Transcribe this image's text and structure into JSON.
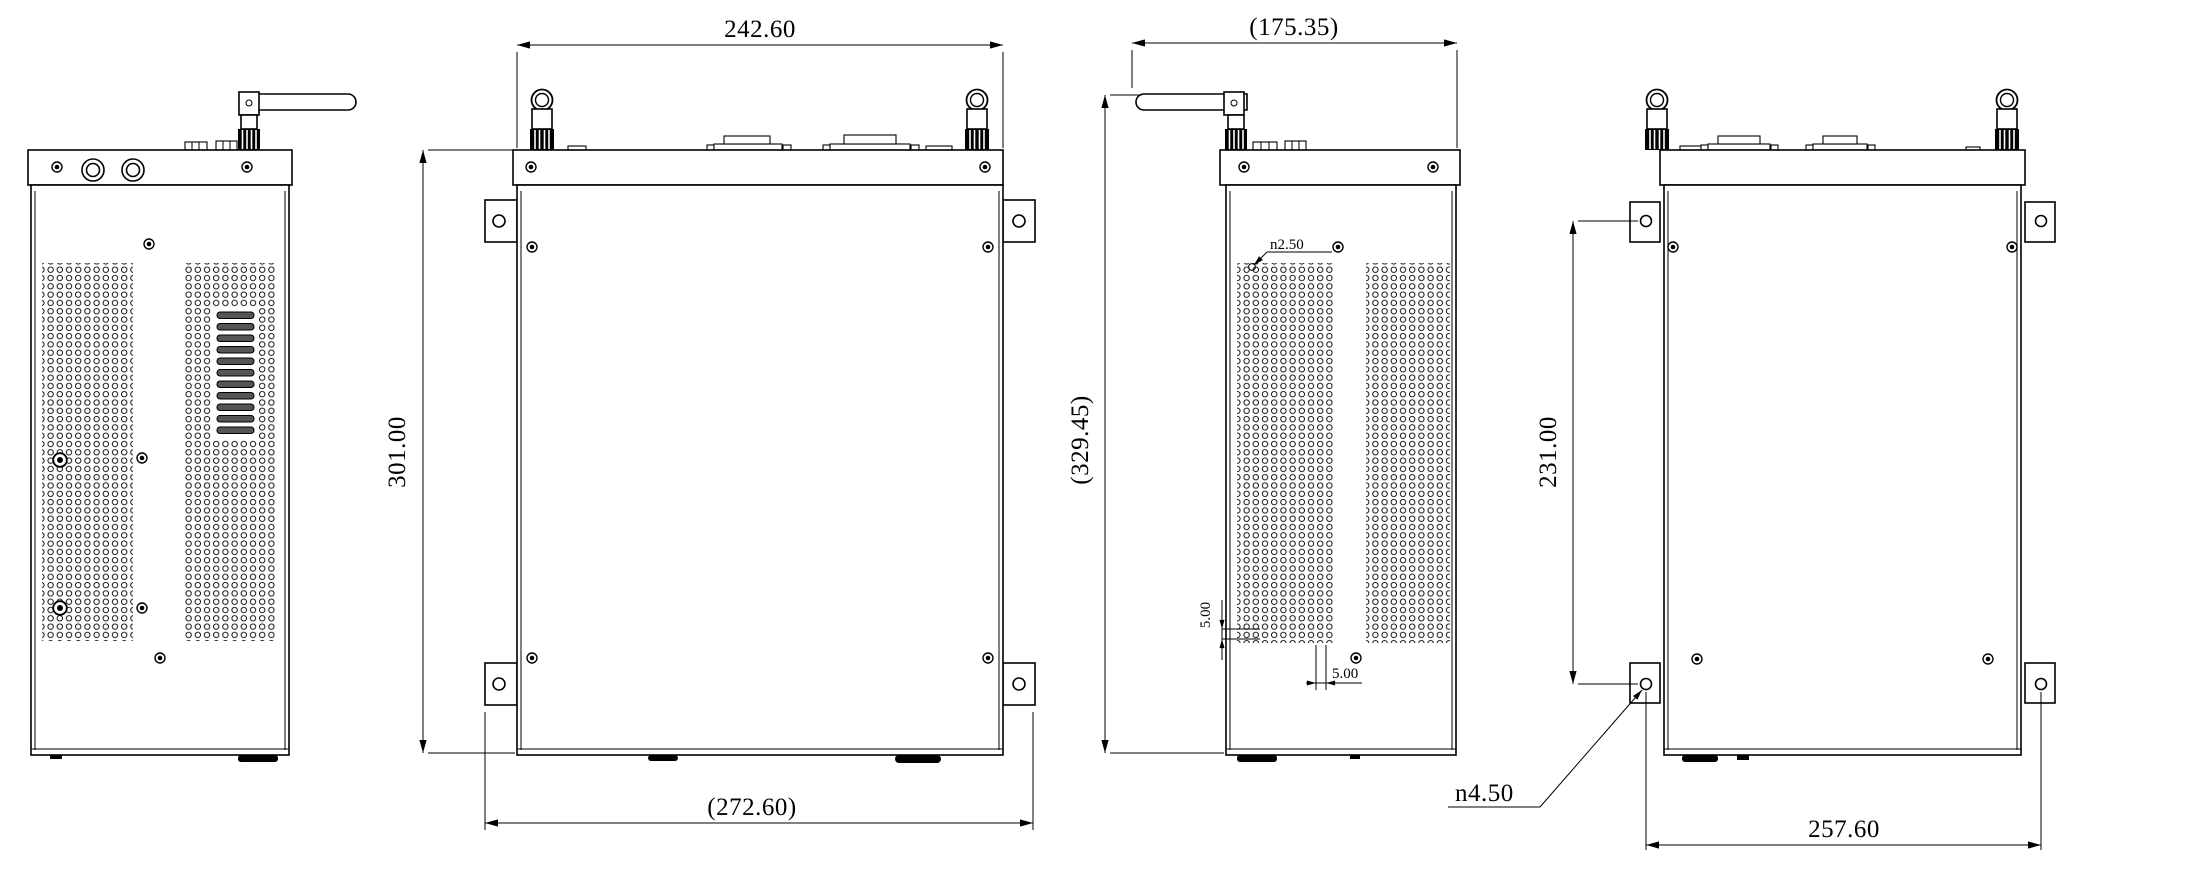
{
  "sheet": {
    "background": "#ffffff",
    "line_color": "#000000"
  },
  "dimensions": {
    "front": {
      "width": "242.60",
      "height": "301.00",
      "mount_width": "(272.60)"
    },
    "side": {
      "depth_with_antenna": "(175.35)",
      "height_with_antenna": "(329.45)",
      "vent_hole_diameter": "n2.50",
      "vent_row_pitch": "5.00",
      "vent_col_pitch": "5.00"
    },
    "rear": {
      "mount_hole_pitch_vertical": "231.00",
      "mount_hole_pitch_horizontal": "257.60",
      "mount_hole_diameter": "n4.50"
    }
  }
}
